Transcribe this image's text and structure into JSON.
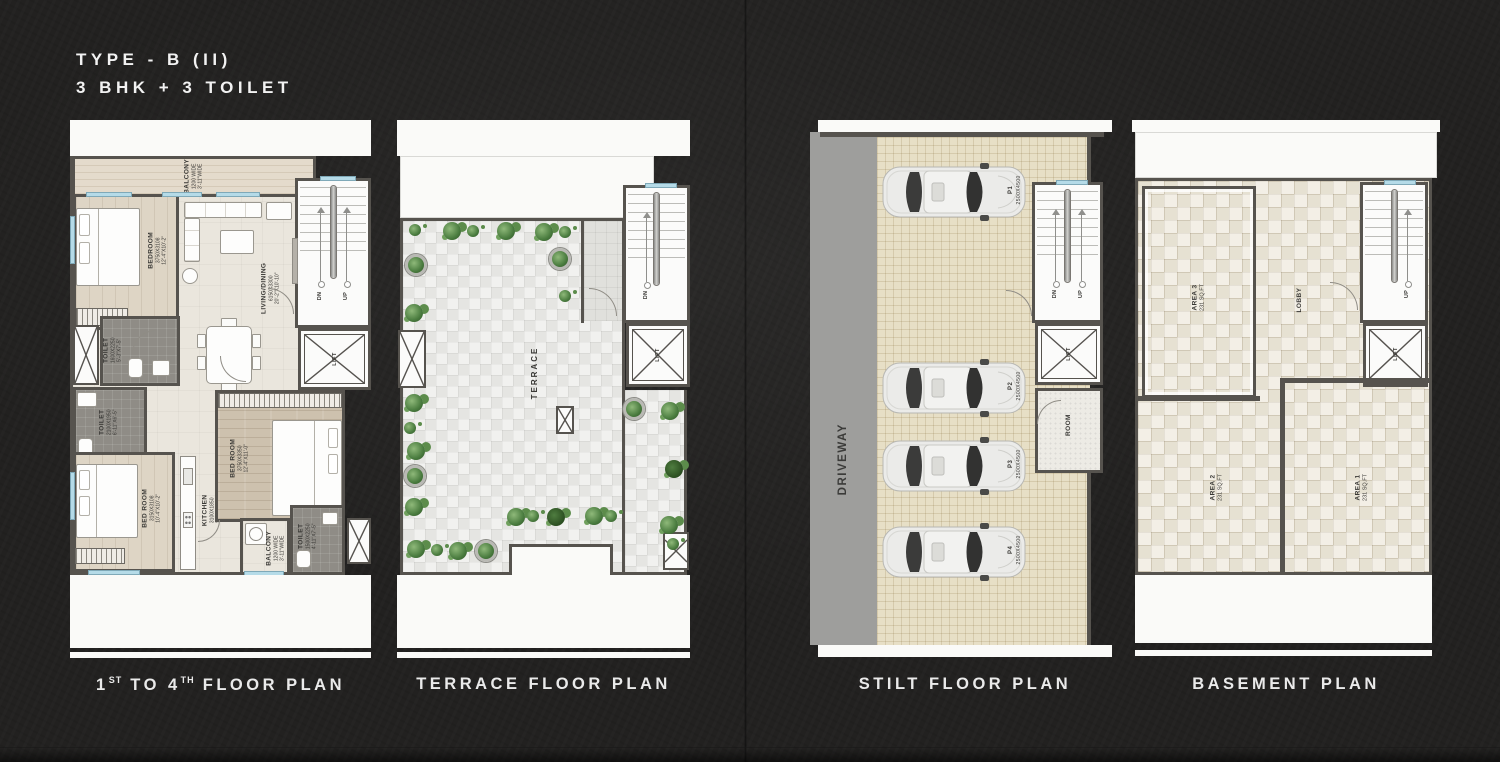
{
  "title": {
    "line1": "TYPE - B (II)",
    "line2": "3 BHK + 3 TOILET"
  },
  "captions": {
    "floor": {
      "pre": "1",
      "sup1": "ST",
      "mid": " TO 4",
      "sup2": "TH",
      "post": " FLOOR PLAN"
    },
    "terrace": "TERRACE FLOOR PLAN",
    "stilt": "STILT FLOOR PLAN",
    "basement": "BASEMENT PLAN"
  },
  "floor_plan": {
    "balcony_top": {
      "name": "BALCONY",
      "l1": "1200 WIDE",
      "l2": "3'-11\"WIDE"
    },
    "bedroom_top": {
      "name": "BEDROOM",
      "l1": "3750X3108",
      "l2": "12'-4\"X10'-2\""
    },
    "living": {
      "name": "LIVING/DINING",
      "l1": "6150X3300",
      "l2": "20'-2\"X10'-10\""
    },
    "toilet_a": {
      "name": "TOILET",
      "l1": "1600X2250",
      "l2": "5'-3\"X7'-5\""
    },
    "toilet_b": {
      "name": "TOILET",
      "l1": "2100X1950",
      "l2": "6'-11\"X6'-5\""
    },
    "kitchen": {
      "name": "KITCHEN",
      "l1": "3100X1850",
      "l2": "10'-2\"X6'-1\""
    },
    "bedroom_left": {
      "name": "BED ROOM",
      "l1": "3150X3108",
      "l2": "10'-4\"X10'-2\""
    },
    "bedroom_right": {
      "name": "BED ROOM",
      "l1": "3750X3350",
      "l2": "12'-4\"X11'-0\""
    },
    "balcony_bottom": {
      "name": "BALCONY",
      "l1": "1200 WIDE",
      "l2": "3'-11\"WIDE"
    },
    "toilet_c": {
      "name": "TOILET",
      "l1": "1500X2250",
      "l2": "4'-11\"X7'-5\""
    },
    "dn": "DN",
    "up": "UP",
    "lift": "LIFT"
  },
  "terrace_plan": {
    "label": "TERRACE",
    "dn": "DN",
    "lift": "LIFT"
  },
  "stilt_plan": {
    "driveway": "DRIVEWAY",
    "room": "ROOM",
    "dn": "DN",
    "up": "UP",
    "lift": "LIFT",
    "parking": [
      {
        "id": "P1",
        "size": "2500X4500"
      },
      {
        "id": "P2",
        "size": "2500X4500"
      },
      {
        "id": "P3",
        "size": "2500X4500"
      },
      {
        "id": "P4",
        "size": "2500X4500"
      }
    ]
  },
  "basement_plan": {
    "lobby": "LOBBY",
    "up": "UP",
    "lift": "LIFT",
    "areas": [
      {
        "name": "AREA 3",
        "size": "231 SQ.FT"
      },
      {
        "name": "AREA 2",
        "size": "231 SQ.FT"
      },
      {
        "name": "AREA 1",
        "size": "231 SQ.FT"
      }
    ]
  },
  "palette": {
    "background": "#222120",
    "wall": "#56534e",
    "floor_cream": "#eae6dd",
    "terrace_tile": "#e9e9e6",
    "stilt_tile": "#e7dfc6",
    "basement_tile": "#ebe5d6",
    "driveway": "#9e9e9c",
    "window_blue": "#b5dbe8",
    "plant_green": "#4a7c3f",
    "label_text": "#3a3936",
    "caption_text": "#eaeaea"
  }
}
